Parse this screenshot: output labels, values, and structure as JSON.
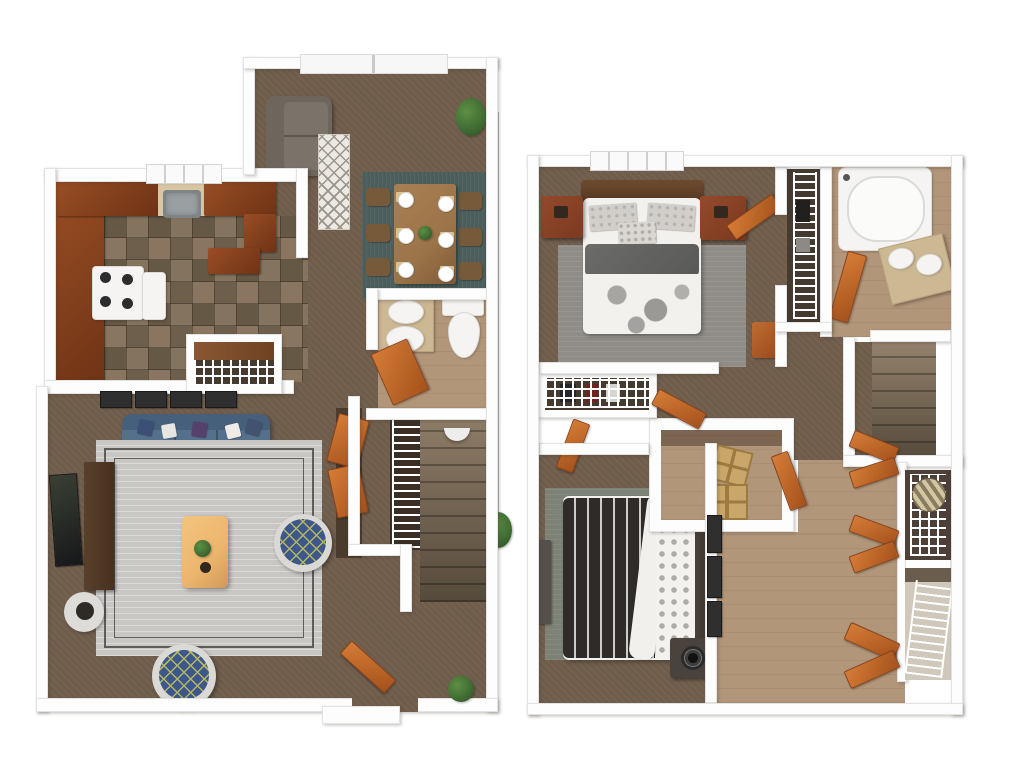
{
  "meta": {
    "kind": "3d-floor-plan-rendering",
    "floors_shown": 2,
    "visible_text": "",
    "background": "#ffffff"
  },
  "palette": {
    "wall_fill": "#fdfdfd",
    "wall_edge": "#e3e3e3",
    "carpet_brown": "#6f5c4b",
    "stair_carpet_light": "#93816c",
    "stair_carpet_dark": "#564a3b",
    "vinyl_tan": "#b2967a",
    "tile_a": "#84735e",
    "tile_b": "#6e5f4d",
    "tile_c": "#8a7660",
    "tile_d": "#655844",
    "counter_wood_light": "#9a4e24",
    "counter_wood_dark": "#6e3315",
    "cabinet_tan": "#d9c6a4",
    "door_orange_light": "#d57c36",
    "door_orange_dark": "#a4511c",
    "sofa_blue": "#54708c",
    "sofa_blue_dark": "#46607b",
    "rug_gray": "#c8c7c4",
    "rug_border_dark": "#3a3a3a",
    "rug_teal": "#4b5e5c",
    "rug_master_gray": "#908c87",
    "rug_bed2_green": "#7d8276",
    "table_wood": "#9c7449",
    "coffee_table_tan": "#ecb56d",
    "console_brown": "#46311f",
    "ottoman_blue": "#3d568c",
    "ottoman_ring": "#dad9d5",
    "ottoman_lattice": "#b3b85e",
    "bed_white": "#f2f1ee",
    "blanket_gray": "#595957",
    "headboard_brown": "#5a3a24",
    "headboard_dark": "#3b332d",
    "stripe_dark": "#2e2b29",
    "stripe_light": "#cfccc7",
    "nightstand_red": "#7b3a21",
    "nightstand_gray": "#4a423c",
    "plant_green": "#3f6b33",
    "plant_green_dark": "#2e4f24",
    "wire_bg": "#453a30",
    "white_fixture": "#f5f4f2",
    "vanity_tan": "#cdb894",
    "metal_gray": "#9aa0a2"
  },
  "floor_plans": [
    {
      "id": "first-floor",
      "position": "left",
      "rooms": [
        {
          "name": "entry-dining",
          "floor": "brown carpet",
          "furniture": [
            "sliding-patio-door",
            "loveseat",
            "diamond-runner-rug",
            "potted-plant",
            "teal-area-rug",
            "dining-table",
            "6 place settings",
            "6 dining chairs"
          ]
        },
        {
          "name": "kitchen",
          "floor": "slate tile",
          "furniture": [
            "u-shaped wood counters",
            "stainless sink",
            "window",
            "gas stove",
            "oven",
            "pantry wire shelving"
          ]
        },
        {
          "name": "half-bathroom",
          "floor": "tan vinyl",
          "furniture": [
            "vanity with sink",
            "toilet",
            "orange door"
          ]
        },
        {
          "name": "stairwell",
          "floor": "brown carpet stairs",
          "furniture": [
            "white railing",
            "wall sconce",
            "closet bifold doors"
          ]
        },
        {
          "name": "living-room",
          "floor": "brown carpet",
          "furniture": [
            "blue sofa with pillows",
            "4 wall pictures",
            "gray bordered area rug",
            "tan coffee table with plant",
            "2 blue lattice ottomans",
            "media console",
            "wall art",
            "round side table",
            "open front door",
            "potted plant",
            "entry stoop"
          ]
        }
      ]
    },
    {
      "id": "second-floor",
      "position": "right",
      "rooms": [
        {
          "name": "master-bedroom",
          "floor": "brown carpet",
          "furniture": [
            "window",
            "bed with gray blanket and dotted duvet",
            "2 red-brown nightstands",
            "gray rug",
            "slippers",
            "orange door",
            "small chest"
          ]
        },
        {
          "name": "master-closet",
          "floor": "dark",
          "furniture": [
            "wire shelving with clothes",
            "orange door"
          ]
        },
        {
          "name": "linen-closet",
          "floor": "dark",
          "furniture": [
            "tall wire shelving with linens"
          ]
        },
        {
          "name": "bathroom",
          "floor": "tan vinyl",
          "furniture": [
            "bathtub",
            "double-sink vanity",
            "orange door"
          ]
        },
        {
          "name": "stairwell",
          "floor": "brown carpet stairs",
          "furniture": []
        },
        {
          "name": "storage-room",
          "floor": "tan vinyl",
          "furniture": [
            "2 wooden crates",
            "orange door"
          ]
        },
        {
          "name": "bedroom-2",
          "floor": "brown carpet",
          "furniture": [
            "bed with black-white striped duvet",
            "dotted pillows",
            "2 nightstands with speakers",
            "green-gray rug",
            "bench",
            "3 wall frames",
            "orange door"
          ]
        },
        {
          "name": "hallway",
          "floor": "tan vinyl",
          "furniture": [
            "3 sets of orange bifold closet doors",
            "closet with clothes and striped hatbox",
            "empty wire-shelf closet"
          ]
        }
      ]
    }
  ],
  "divider": {
    "style": "thin gray vertical line with small plant",
    "color": "#b5b2ac"
  }
}
